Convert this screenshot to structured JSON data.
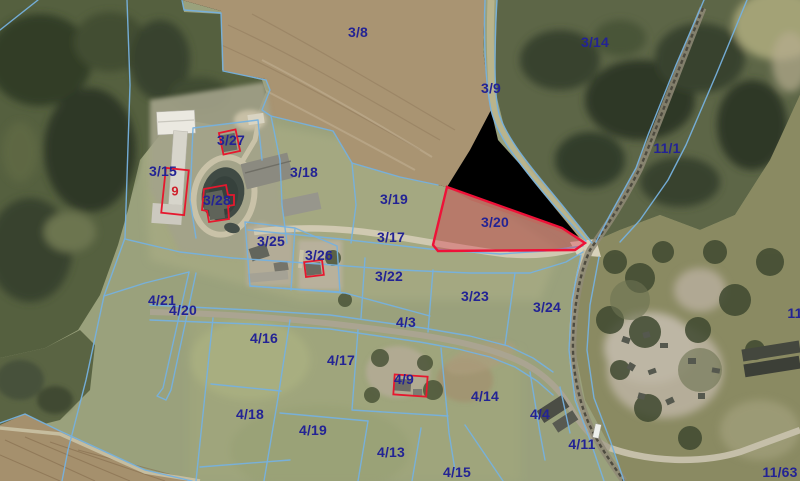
{
  "map": {
    "highlighted_parcel": {
      "label": "3/20",
      "x": 495,
      "y": 222,
      "fill": "rgba(222,30,62,0.33)",
      "stroke": "#ee1238"
    },
    "colors": {
      "boundary_line": "#76b1de",
      "parcel_label": "#232394",
      "building_outline": "#e6182e",
      "building_label": "#cf1f2a"
    },
    "parcel_labels": [
      {
        "text": "3/8",
        "x": 358,
        "y": 32
      },
      {
        "text": "3/14",
        "x": 595,
        "y": 42
      },
      {
        "text": "3/9",
        "x": 491,
        "y": 88
      },
      {
        "text": "11/1",
        "x": 667,
        "y": 148
      },
      {
        "text": "3/27",
        "x": 231,
        "y": 140
      },
      {
        "text": "3/15",
        "x": 163,
        "y": 171
      },
      {
        "text": "3/18",
        "x": 304,
        "y": 172
      },
      {
        "text": "3/28",
        "x": 217,
        "y": 200
      },
      {
        "text": "3/19",
        "x": 394,
        "y": 199
      },
      {
        "text": "3/17",
        "x": 391,
        "y": 237
      },
      {
        "text": "3/25",
        "x": 271,
        "y": 241
      },
      {
        "text": "3/26",
        "x": 319,
        "y": 255
      },
      {
        "text": "3/22",
        "x": 389,
        "y": 276
      },
      {
        "text": "3/23",
        "x": 475,
        "y": 296
      },
      {
        "text": "3/24",
        "x": 547,
        "y": 307
      },
      {
        "text": "4/21",
        "x": 162,
        "y": 300
      },
      {
        "text": "4/20",
        "x": 183,
        "y": 310
      },
      {
        "text": "4/3",
        "x": 406,
        "y": 322
      },
      {
        "text": "11/",
        "x": 797,
        "y": 313
      },
      {
        "text": "4/16",
        "x": 264,
        "y": 338
      },
      {
        "text": "4/17",
        "x": 341,
        "y": 360
      },
      {
        "text": "4/9",
        "x": 404,
        "y": 379
      },
      {
        "text": "4/14",
        "x": 485,
        "y": 396
      },
      {
        "text": "4/18",
        "x": 250,
        "y": 414
      },
      {
        "text": "4/19",
        "x": 313,
        "y": 430
      },
      {
        "text": "4/4",
        "x": 540,
        "y": 414
      },
      {
        "text": "4/13",
        "x": 391,
        "y": 452
      },
      {
        "text": "4/11",
        "x": 582,
        "y": 444
      },
      {
        "text": "4/15",
        "x": 457,
        "y": 472
      },
      {
        "text": "11/63",
        "x": 780,
        "y": 472
      }
    ],
    "building_labels": [
      {
        "text": "9",
        "x": 175,
        "y": 191
      }
    ]
  }
}
